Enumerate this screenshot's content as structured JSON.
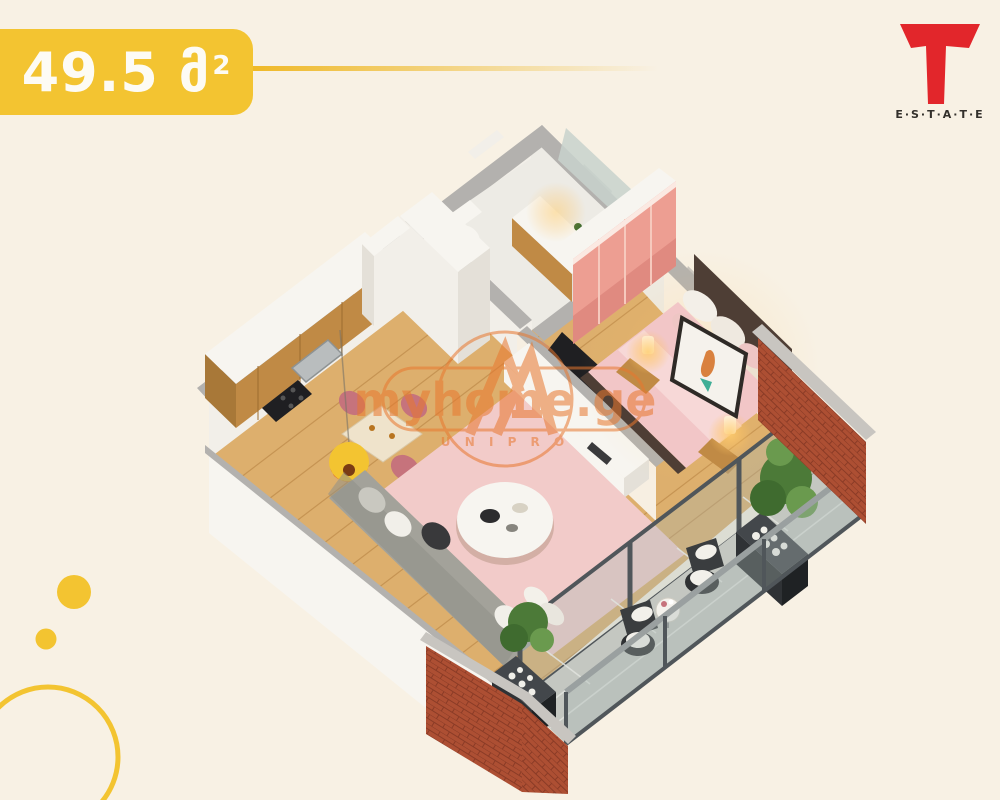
{
  "banner": {
    "area_value": "49.5",
    "area_unit": "მ",
    "area_sup": "2"
  },
  "logo": {
    "word": "E·S·T·A·T·E",
    "mark_letter": "T"
  },
  "watermark": {
    "site": "myhome.ge",
    "sub": "U N I P R O"
  },
  "palette": {
    "bg": "#f8f1e4",
    "yellow": "#f3c431",
    "yellowDeep": "#efb928",
    "red": "#e2262b",
    "ink": "#33302b",
    "orange": "#e8772e",
    "wallTop": "#b3b1ae",
    "wallTopLight": "#c8c5c0",
    "wallFace": "#f2efe9",
    "wallWarm": "#f7efe2",
    "wallExt": "#e9e5de",
    "marble": "#edebe5",
    "wood": "#ddaf6d",
    "woodSeam": "#b07a3a",
    "woodDark": "#c08a45",
    "cabinet": "#55534c",
    "white": "#f7f5f0",
    "whiteDim": "#e4e0d8",
    "cream": "#efe3cb",
    "rose": "#c6737c",
    "pinkRug": "#f2cbc9",
    "pinkBed": "#f2c6c7",
    "pinkWard": "#ed9e92",
    "pinkWardDark": "#e08a80",
    "headboard": "#4e3e35",
    "sofa": "#a3a29a",
    "sofaDark": "#8f8f88",
    "sofaLight": "#c9c8c0",
    "tile": "#c4c7c1",
    "grout": "#e0e2dd",
    "brick": "#ad4f33",
    "brickDark": "#8a3b26",
    "glassFill": "rgba(168,182,180,0.34)",
    "frame": "#50565a",
    "rail": "#9aa0a0",
    "plant": "#4c7a38",
    "plantLight": "#6a9a4e",
    "plantDark": "#3f6b2f",
    "planter": "#2f3235",
    "tv": "#1f1f22",
    "glow": "rgba(255,196,98,0.55)"
  }
}
